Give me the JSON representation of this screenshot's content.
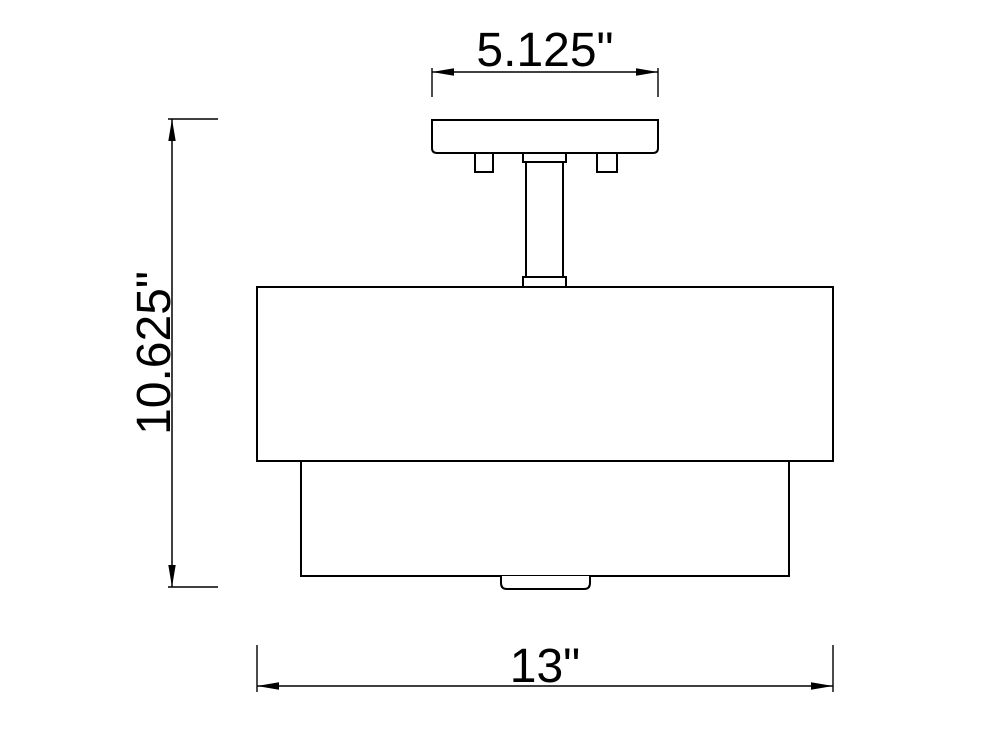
{
  "drawing": {
    "type": "technical-dimension-drawing",
    "subject": "semi-flush ceiling light fixture, front elevation",
    "colors": {
      "line": "#000000",
      "background": "#ffffff"
    },
    "dimensions": {
      "canopy_width": {
        "label": "5.125\"",
        "applies_to": "mounting canopy width"
      },
      "overall_height": {
        "label": "10.625\"",
        "applies_to": "overall fixture height"
      },
      "shade_width": {
        "label": "13\"",
        "applies_to": "outer drum shade width"
      }
    }
  }
}
